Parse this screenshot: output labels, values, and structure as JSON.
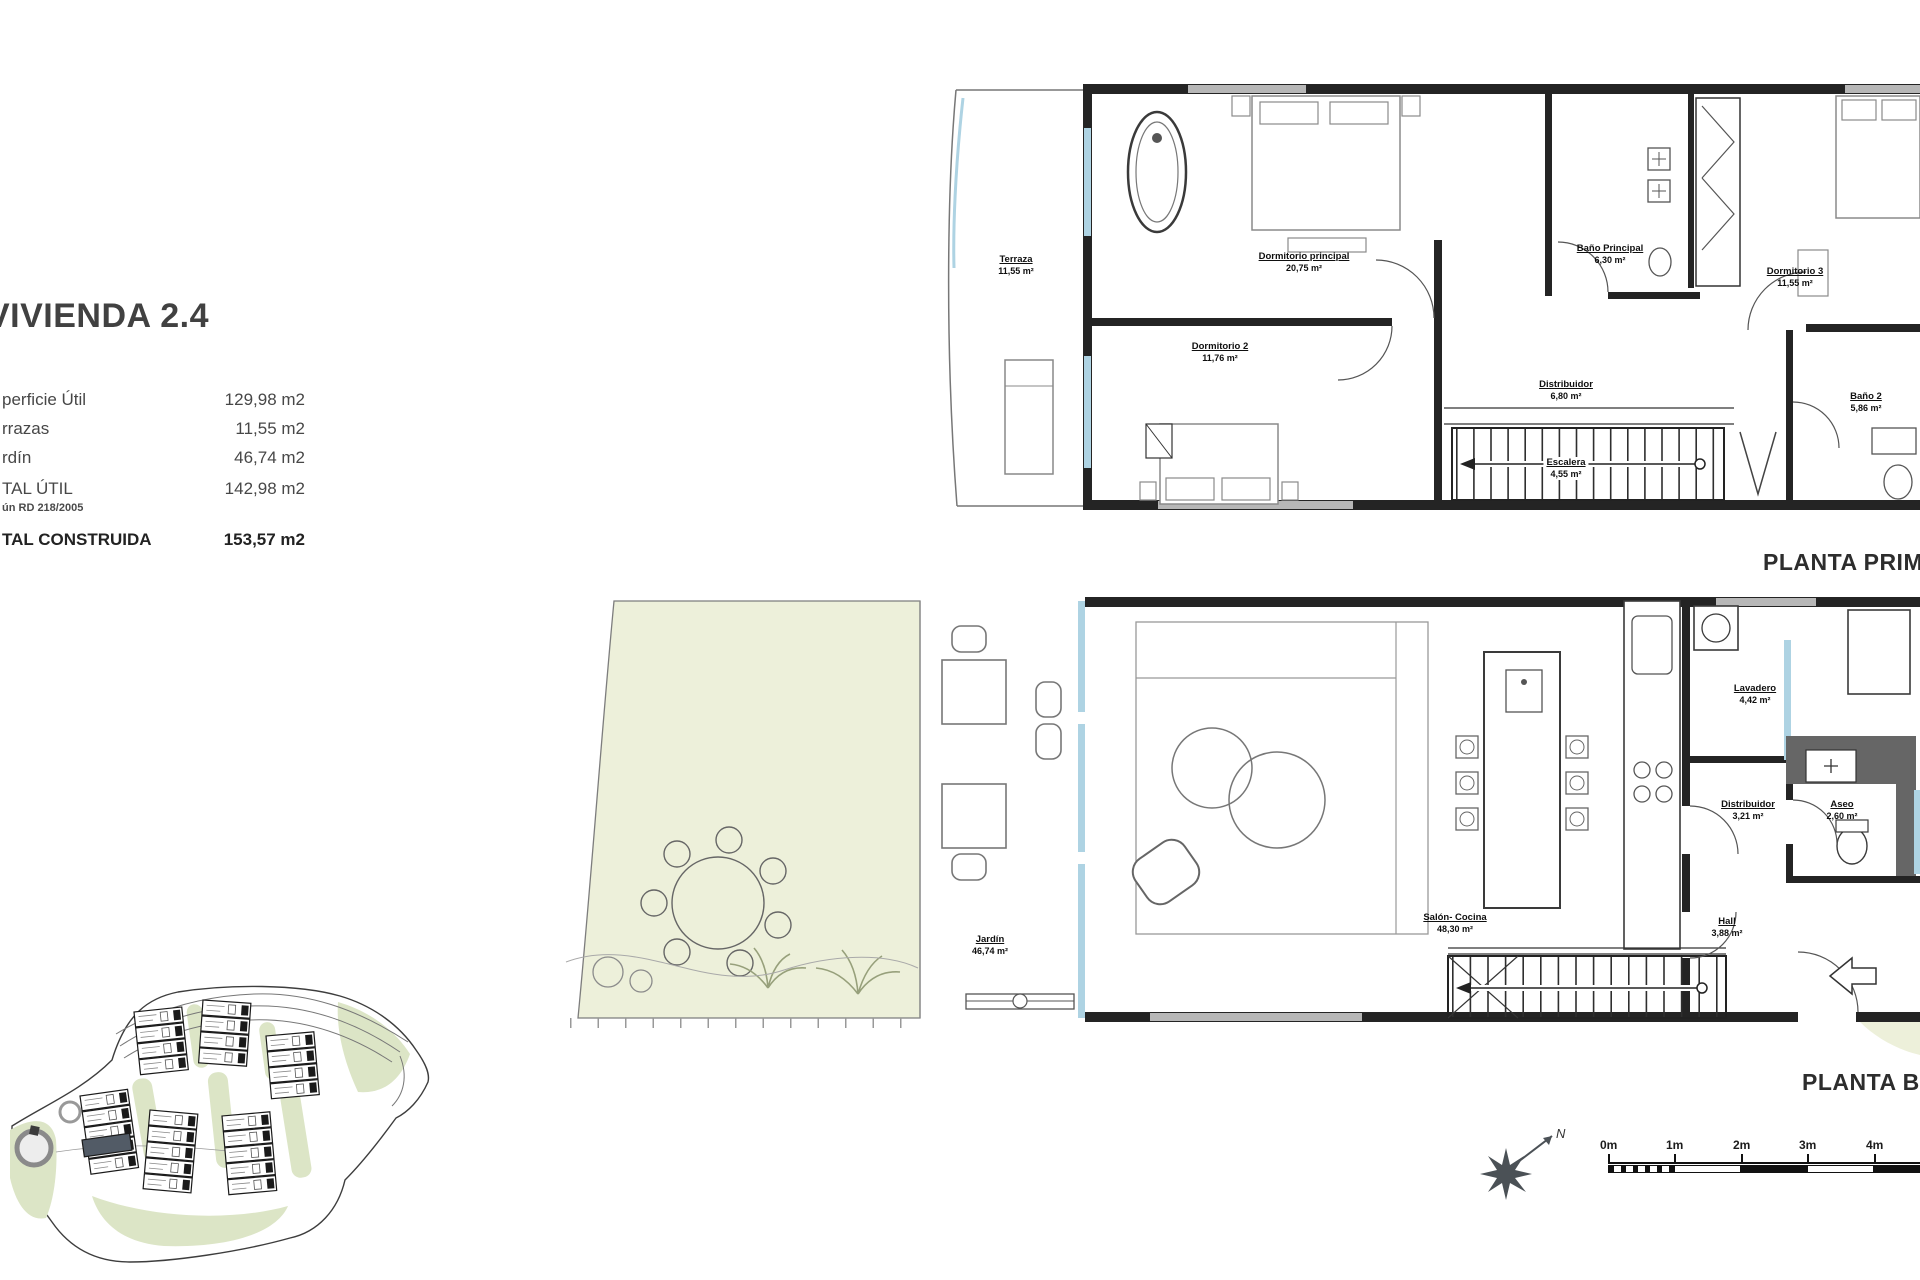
{
  "info_panel": {
    "title": "VIVIENDA 2.4",
    "rows": [
      {
        "label": "perficie Útil",
        "value": "129,98 m2"
      },
      {
        "label": "rrazas",
        "value": "11,55 m2"
      },
      {
        "label": "rdín",
        "value": "46,74 m2"
      },
      {
        "label": "TAL ÚTIL",
        "value": "142,98 m2"
      },
      {
        "label": "TAL CONSTRUIDA",
        "value": "153,57 m2"
      }
    ],
    "note": "ún RD 218/2005"
  },
  "first_floor": {
    "caption": "PLANTA PRIMERA",
    "rooms": [
      {
        "name": "Terraza",
        "area": "11,55 m²"
      },
      {
        "name": "Dormitorio principal",
        "area": "20,75 m²"
      },
      {
        "name": "Baño Principal",
        "area": "6,30 m²"
      },
      {
        "name": "Dormitorio 3",
        "area": "11,55 m²"
      },
      {
        "name": "Dormitorio 2",
        "area": "11,76 m²"
      },
      {
        "name": "Distribuidor",
        "area": "6,80 m²"
      },
      {
        "name": "Escalera",
        "area": "4,55 m²"
      },
      {
        "name": "Baño 2",
        "area": "5,86 m²"
      }
    ]
  },
  "ground_floor": {
    "caption": "PLANTA BAJA",
    "rooms": [
      {
        "name": "Jardín",
        "area": "46,74 m²"
      },
      {
        "name": "Salón- Cocina",
        "area": "48,30 m²"
      },
      {
        "name": "Lavadero",
        "area": "4,42 m²"
      },
      {
        "name": "Distribuidor",
        "area": "3,21 m²"
      },
      {
        "name": "Aseo",
        "area": "2,60 m²"
      },
      {
        "name": "Hall",
        "area": "3,88 m²"
      }
    ]
  },
  "scale_bar": {
    "ticks": [
      "0m",
      "1m",
      "2m",
      "3m",
      "4m"
    ]
  },
  "compass": {
    "label": "N"
  },
  "colors": {
    "wall": "#242424",
    "glazing_blue": "#aed3e3",
    "garden_green": "#edf0da",
    "site_green": "#dce5c6",
    "highlight_unit": "#525b66"
  }
}
